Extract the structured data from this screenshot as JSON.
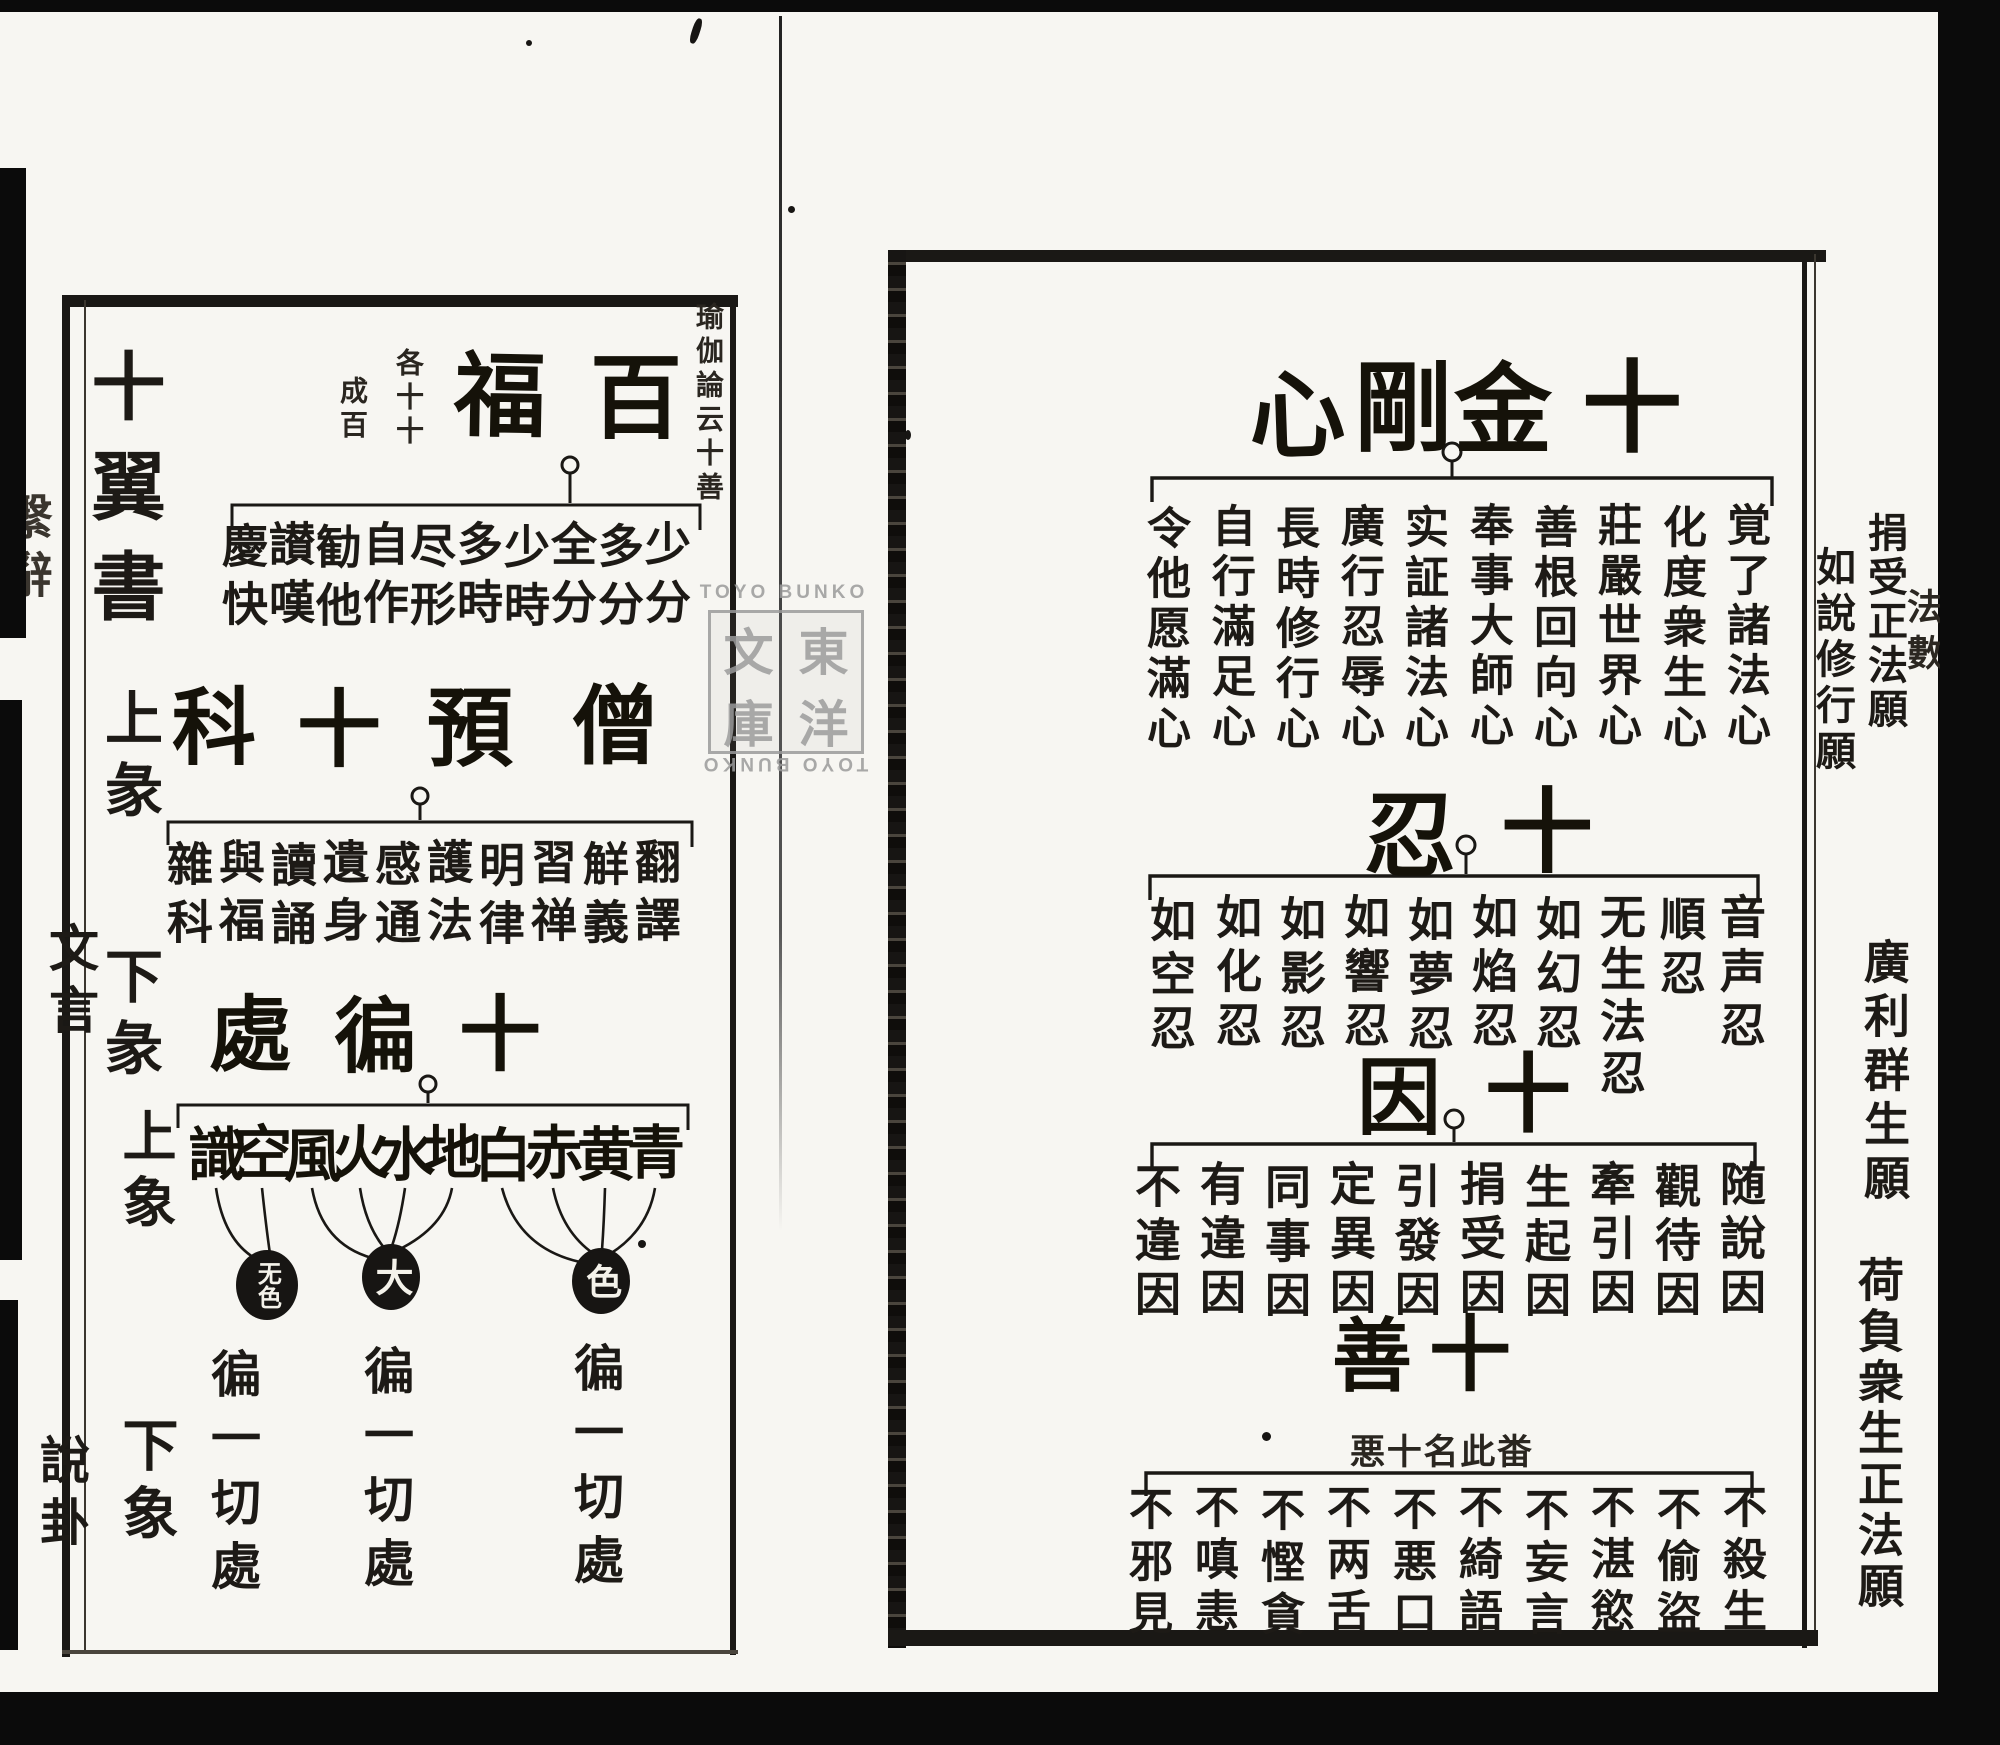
{
  "watermark": {
    "top_text": "TOYO BUNKO",
    "bottom_text": "TOYO BUNKO",
    "seal": [
      "東",
      "洋",
      "文",
      "庫"
    ]
  },
  "right_page": {
    "fore_edge_label": "法數",
    "margin": {
      "vow_1": "捐受正法願",
      "vow_2": "如說修行願",
      "vow_3": "廣利群生願",
      "vow_4": "荷負衆生正法願"
    },
    "section_kongo": {
      "title": [
        "十",
        "金",
        "剛",
        "心"
      ],
      "items": [
        "覚了諸法心",
        "化度衆生心",
        "莊嚴世界心",
        "善根回向心",
        "奉事大師心",
        "实証諸法心",
        "廣行忍辱心",
        "長時修行心",
        "自行滿足心",
        "令他愿滿心"
      ]
    },
    "section_nin": {
      "title": [
        "十",
        "忍"
      ],
      "items": [
        "音声忍",
        "順忍",
        "无生法忍",
        "如幻忍",
        "如焰忍",
        "如夢忍",
        "如響忍",
        "如影忍",
        "如化忍",
        "如空忍"
      ]
    },
    "section_in": {
      "title": [
        "十",
        "因"
      ],
      "items": [
        "随說因",
        "觀待因",
        "牽引因",
        "生起因",
        "捐受因",
        "引發因",
        "定異因",
        "同事因",
        "有違因",
        "不違因"
      ]
    },
    "section_zen": {
      "title": [
        "十",
        "善"
      ],
      "note_glyphs": [
        "悪",
        "十",
        "名",
        "此",
        "畨"
      ],
      "items": [
        "不殺生",
        "不偷盜",
        "不湛慾",
        "不妄言",
        "不綺語",
        "不悪口",
        "不两舌",
        "不慳貪",
        "不嗔恚",
        "不邪見"
      ]
    }
  },
  "left_page": {
    "margin": {
      "label_1": "十翼書",
      "label_2": "上彖",
      "label_3": "下彖",
      "label_4": "文言",
      "label_5": "上象",
      "label_6": "下象",
      "label_7": "說卦",
      "edge_partial": "繫辭"
    },
    "section_fuku": {
      "title": [
        "百",
        "福"
      ],
      "note_source": "瑜伽論云十善",
      "note_a": "各十十",
      "note_b": "成百",
      "items": [
        "少分",
        "多分",
        "全分",
        "少時",
        "多時",
        "尽形",
        "自作",
        "勧他",
        "讃嘆",
        "慶快"
      ]
    },
    "section_ka": {
      "title": [
        "僧",
        "預",
        "十",
        "科"
      ],
      "items": [
        "翻譯",
        "觧義",
        "習禅",
        "明律",
        "護法",
        "感通",
        "遺身",
        "讀誦",
        "與福",
        "雜科"
      ]
    },
    "section_hen": {
      "title": [
        "十",
        "徧",
        "處"
      ],
      "items": [
        "青",
        "黄",
        "赤",
        "白",
        "地",
        "水",
        "火",
        "風",
        "空",
        "識"
      ],
      "circle_1": "色",
      "circle_2": "大",
      "circle_3": "无色",
      "repeat_label_1": "徧一切處",
      "repeat_label_2": "徧一切處",
      "repeat_label_3": "徧一切處"
    }
  }
}
